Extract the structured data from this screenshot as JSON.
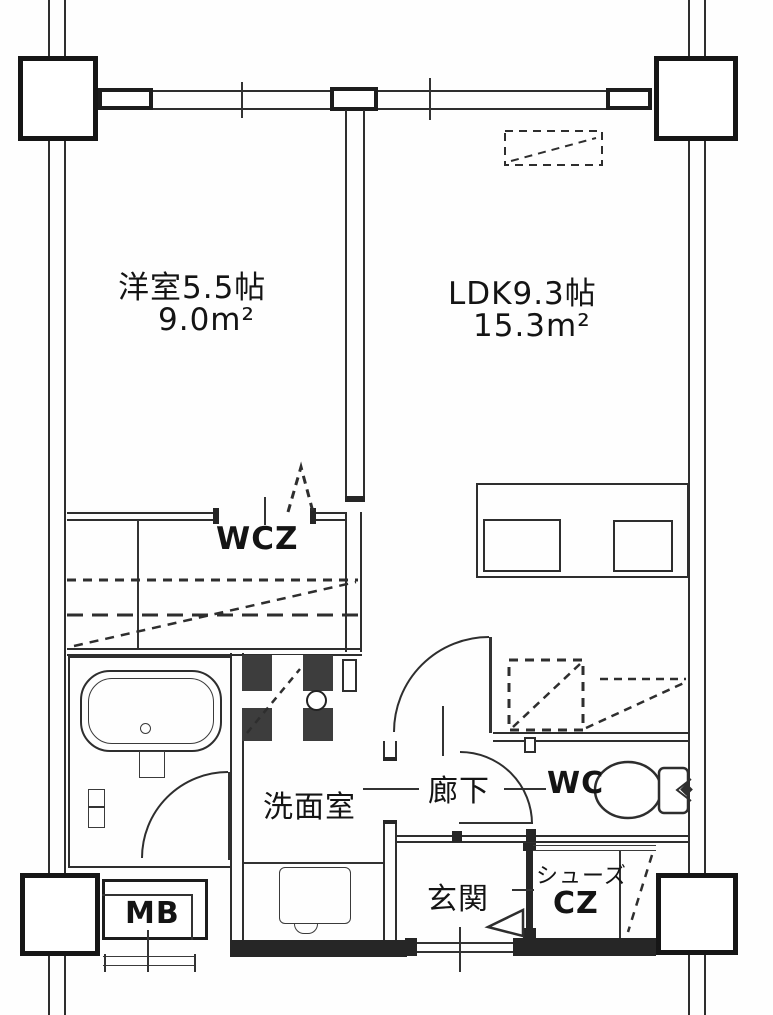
{
  "meta": {
    "drawing_type": "japanese-apartment-floor-plan",
    "style": "black-and-white scanned blueprint"
  },
  "colors": {
    "paper": "#fefefe",
    "line": "#2e2e2e",
    "dark_fill": "#3d3d3d"
  },
  "rooms": {
    "western_room": {
      "label": "洋室5.5帖",
      "area": "9.0m²"
    },
    "ldk": {
      "label": "LDK9.3帖",
      "area": "15.3m²"
    },
    "wcz": {
      "label": "WCZ"
    },
    "washroom": {
      "label": "洗面室"
    },
    "hallway": {
      "label": "廊下"
    },
    "toilet_room": {
      "label": "WC"
    },
    "entrance": {
      "label": "玄関"
    },
    "shoes_closet": {
      "label_line1": "シューズ",
      "label_line2": "CZ"
    },
    "meter_box": {
      "label": "MB"
    }
  }
}
